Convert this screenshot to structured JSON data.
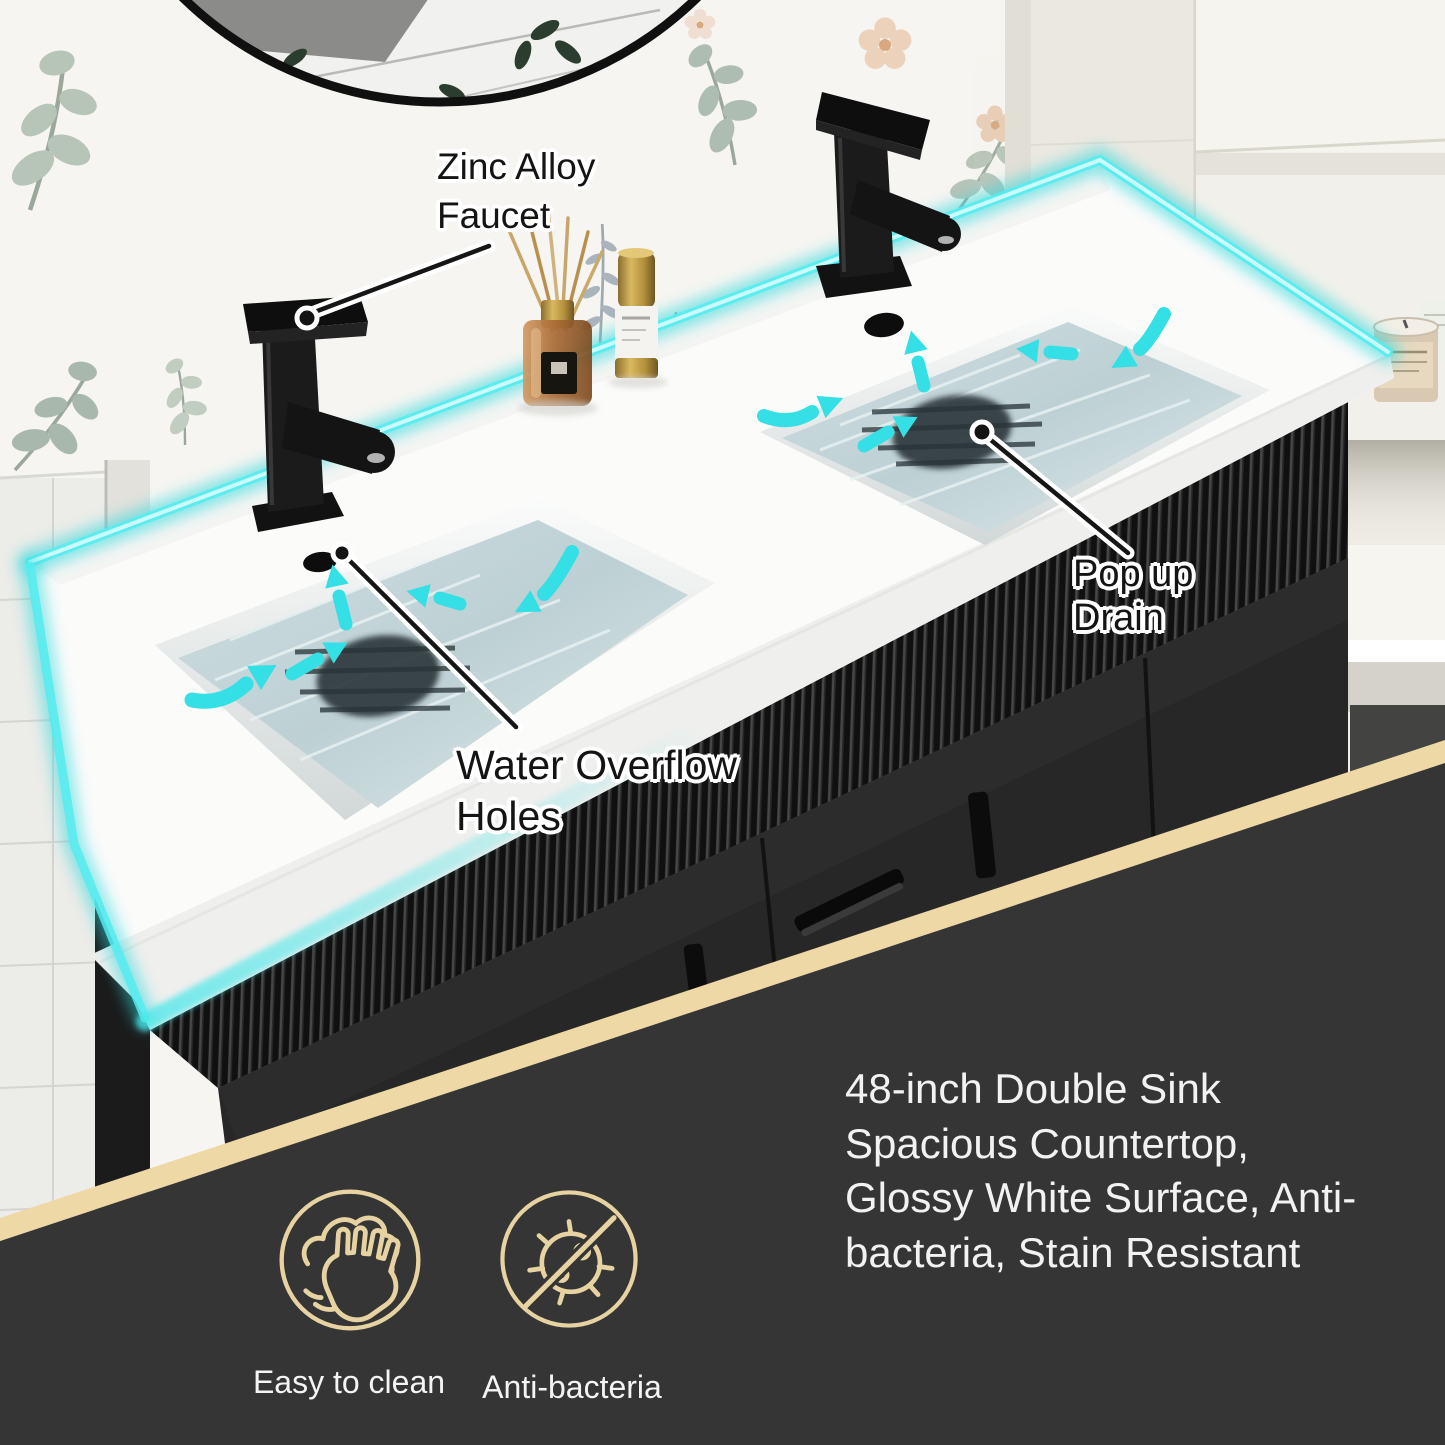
{
  "callouts": {
    "faucet": {
      "label": "Zinc Alloy Faucet"
    },
    "drain": {
      "label": "Pop up Drain"
    },
    "overflow": {
      "label": "Water Overflow Holes"
    }
  },
  "features": {
    "headline": "48-inch Double Sink Spacious Countertop, Glossy White Surface, Anti-bacteria, Stain Resistant",
    "badges": [
      {
        "icon": "wipe-hand-icon",
        "label": "Easy to clean"
      },
      {
        "icon": "no-bacteria-icon",
        "label": "Anti-bacteria"
      }
    ]
  },
  "colors": {
    "led_glow": "#49e7ea",
    "band_tan": "#edd8a6",
    "overlay_dark": "#353535",
    "water": "#c3d5d8",
    "counter_white": "#fbfbfa",
    "cabinet_black": "#1c1c1c",
    "label_text_dark": "#141414",
    "label_text_light": "#f2f2f2"
  }
}
